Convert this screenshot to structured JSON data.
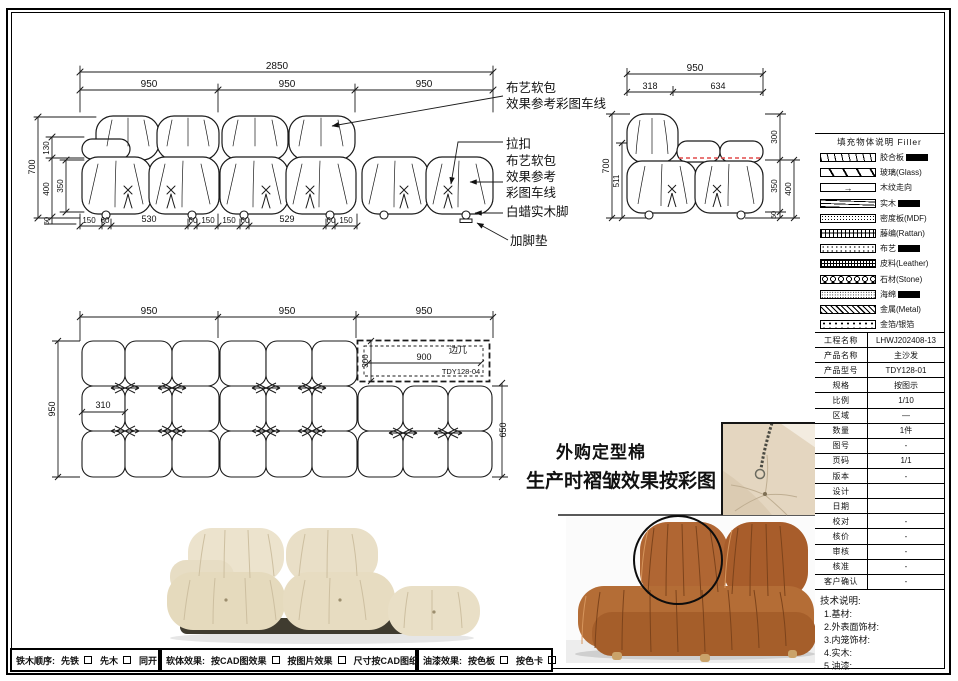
{
  "front_view": {
    "dims": {
      "overall": "2850",
      "seg": [
        "950",
        "950",
        "950"
      ],
      "h700": "700",
      "h130": "130",
      "h400": "400",
      "h350": "350",
      "h50": "50",
      "bottom": [
        "150",
        "60",
        "530",
        "60",
        "150",
        "150",
        "60",
        "529",
        "60",
        "150"
      ]
    },
    "callouts": {
      "c1a": "布艺软包",
      "c1b": "效果参考彩图车线",
      "c2": "拉扣",
      "c3a": "布艺软包",
      "c3b": "效果参考",
      "c3c": "彩图车线",
      "c4": "白蜡实木脚",
      "c5": "加脚垫"
    }
  },
  "side_view": {
    "dims": {
      "overall": "950",
      "seg": [
        "318",
        "634"
      ],
      "h700": "700",
      "h511": "511",
      "r300": "300",
      "r350": "350",
      "r400": "400",
      "r50": "50"
    }
  },
  "plan_view": {
    "dims": {
      "seg": [
        "950",
        "950",
        "950"
      ],
      "depth": "950",
      "arm": "310",
      "right": "650",
      "table_w": "900",
      "table_d": "300"
    },
    "side_table": {
      "label": "边几",
      "model": "TDY128-04"
    }
  },
  "center_note": {
    "line1": "外购定型棉",
    "line2": "生产时褶皱效果按彩图"
  },
  "icons": {
    "wood_grain_arrow": "→"
  },
  "legend": {
    "title": "填充物体说明  Filler",
    "items": [
      {
        "label": "胶合板",
        "highlight": true
      },
      {
        "label": "玻璃(Glass)",
        "highlight": false
      },
      {
        "label": "木纹走向",
        "highlight": false
      },
      {
        "label": "实木",
        "highlight": true
      },
      {
        "label": "密度板(MDF)",
        "highlight": false
      },
      {
        "label": "藤编(Rattan)",
        "highlight": false
      },
      {
        "label": "布艺",
        "highlight": true
      },
      {
        "label": "皮料(Leather)",
        "highlight": false
      },
      {
        "label": "石材(Stone)",
        "highlight": false
      },
      {
        "label": "海绵",
        "highlight": true
      },
      {
        "label": "金属(Metal)",
        "highlight": false
      },
      {
        "label": "金箔/银箔",
        "highlight": false
      }
    ]
  },
  "title_block": {
    "rows": [
      {
        "label": "工程名称",
        "value": "LHWJ202408-13"
      },
      {
        "label": "产品名称",
        "value": "主沙发"
      },
      {
        "label": "产品型号",
        "value": "TDY128-01"
      },
      {
        "label": "规格",
        "value": "按图示"
      },
      {
        "label": "比例",
        "value": "1/10"
      },
      {
        "label": "区域",
        "value": "—"
      },
      {
        "label": "数量",
        "value": "1件"
      },
      {
        "label": "图号",
        "value": "-"
      },
      {
        "label": "页码",
        "value": "1/1"
      },
      {
        "label": "版本",
        "value": "-"
      },
      {
        "label": "设计",
        "value": ""
      },
      {
        "label": "日期",
        "value": ""
      },
      {
        "label": "校对",
        "value": "-"
      },
      {
        "label": "核价",
        "value": "-"
      },
      {
        "label": "审核",
        "value": "-"
      },
      {
        "label": "核准",
        "value": "-"
      },
      {
        "label": "客户确认",
        "value": "-"
      }
    ]
  },
  "tech_notes": {
    "title": "技术说明:",
    "items": [
      "1.基材:",
      "2.外表面饰材:",
      "3.内笼饰材:",
      "4.实木:",
      "5.油漆:"
    ]
  },
  "footer": {
    "g1": {
      "title": "铁木顺序:",
      "o1": "先铁",
      "o2": "先木",
      "o3": "同开"
    },
    "g2": {
      "title": "软体效果:",
      "o1": "按CAD图效果",
      "o2": "按图片效果",
      "o3": "尺寸按CAD图纸"
    },
    "g3": {
      "title": "油漆效果:",
      "o1": "按色板",
      "o2": "按色卡"
    }
  },
  "colors": {
    "line": "#1a1a1a",
    "red_dash": "#e24b4b",
    "cream": "#e8dfca",
    "orange": "#b4672e"
  }
}
